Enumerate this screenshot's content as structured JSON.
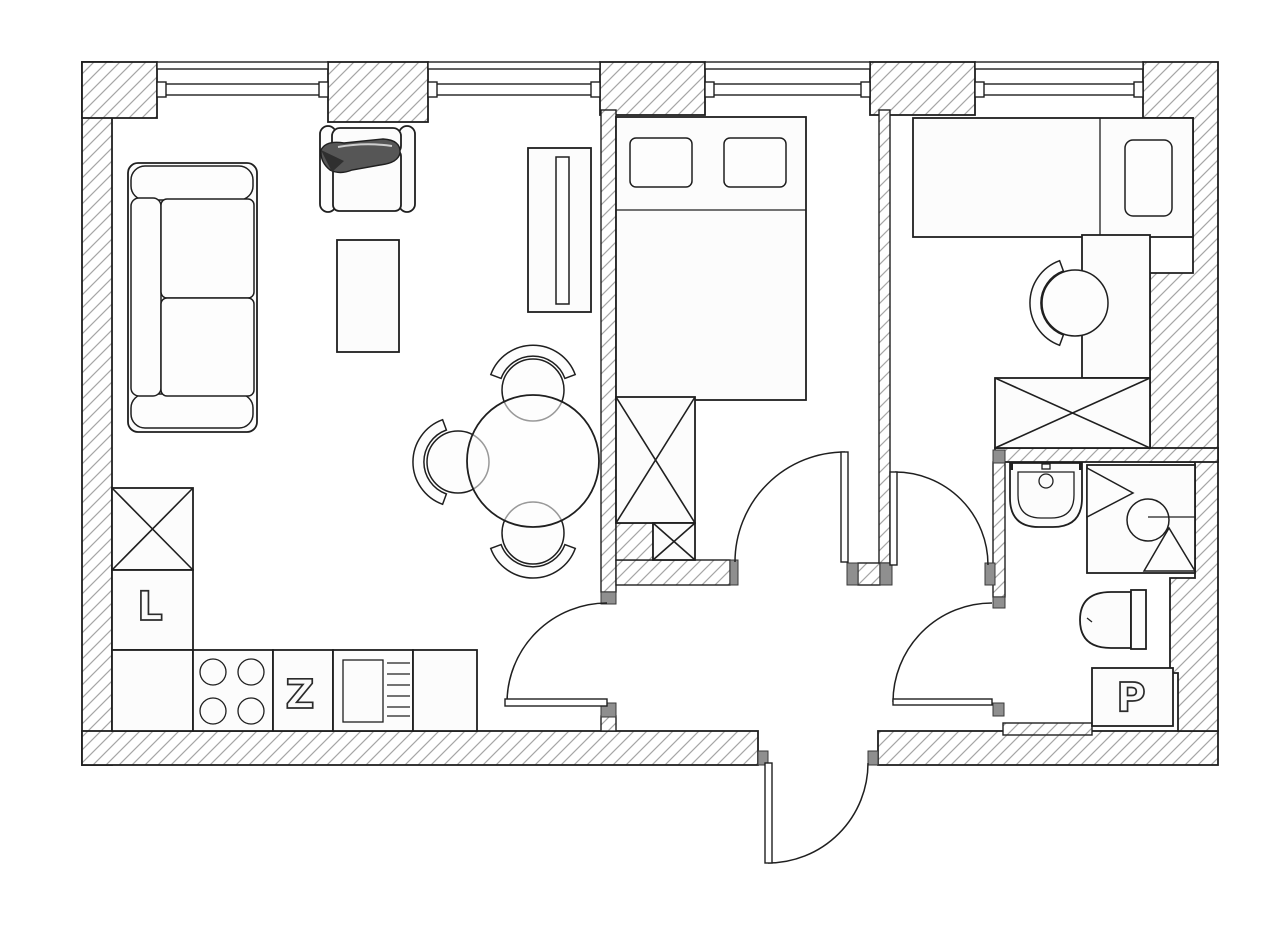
{
  "floorplan": {
    "labels": {
      "refrigerator": "L",
      "dishwasher": "Z",
      "washing_machine": "P"
    },
    "colors": {
      "line": "#1f1f1f",
      "wall_hatch": "#a6a6a6",
      "door_jamb": "#8f8f8f",
      "paper": "#ffffff",
      "throw_blanket": "#555555"
    }
  }
}
